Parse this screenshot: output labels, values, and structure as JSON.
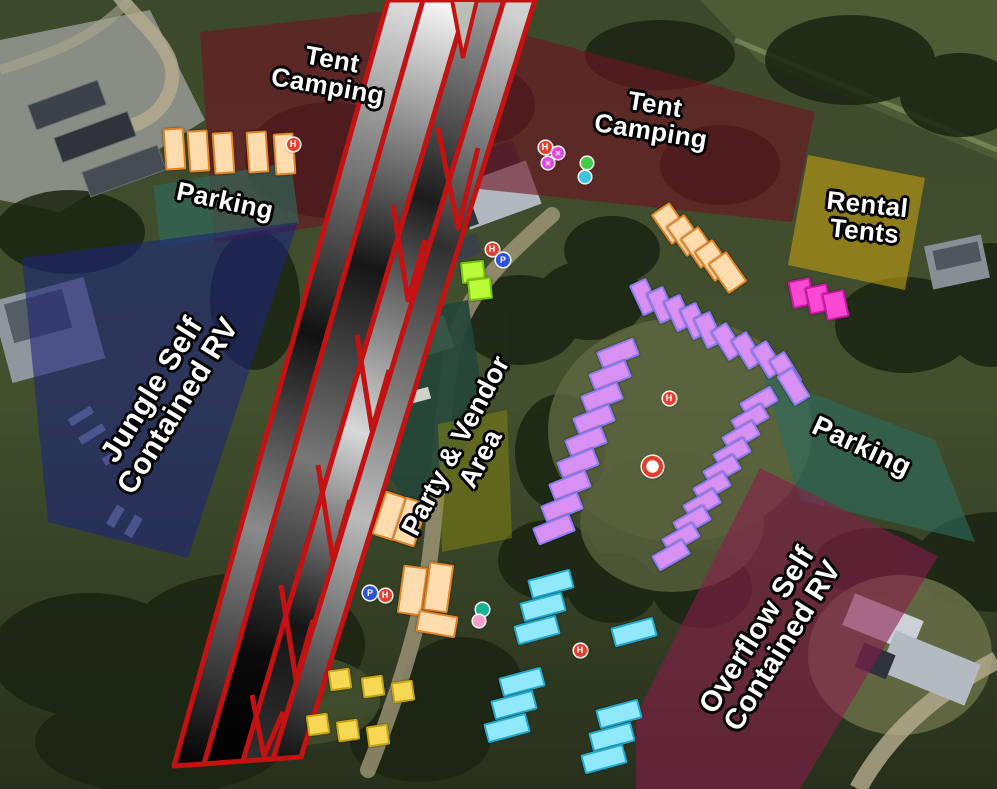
{
  "map": {
    "type": "campground-event-site-map",
    "background_style": "satellite-aerial",
    "hatch_band": {
      "stroke": "#c41111",
      "meaning": "closed-route-hatching"
    },
    "zones": [
      {
        "id": "tent-camping-nw",
        "fill": "#6e1422",
        "opacity": 0.62,
        "points": [
          [
            200,
            32
          ],
          [
            398,
            10
          ],
          [
            408,
            212
          ],
          [
            214,
            243
          ]
        ],
        "label_lines": [
          "Tent",
          "Camping"
        ],
        "label_x": 330,
        "label_y": 73,
        "label_rot": 10,
        "label_size": 26
      },
      {
        "id": "parking-nw",
        "fill": "#2e6b5c",
        "opacity": 0.64,
        "points": [
          [
            153,
            186
          ],
          [
            291,
            162
          ],
          [
            299,
            224
          ],
          [
            161,
            248
          ]
        ],
        "label_lines": [
          "Parking"
        ],
        "label_x": 225,
        "label_y": 201,
        "label_rot": 12,
        "label_size": 26
      },
      {
        "id": "jungle-self-contained-rv",
        "fill": "#1c2478",
        "opacity": 0.6,
        "points": [
          [
            22,
            258
          ],
          [
            298,
            222
          ],
          [
            188,
            558
          ],
          [
            48,
            522
          ]
        ],
        "label_lines": [
          "Jungle Self",
          "Contained RV"
        ],
        "label_x": 165,
        "label_y": 398,
        "label_rot": -58,
        "label_size": 30
      },
      {
        "id": "tent-camping-ne",
        "fill": "#6e1422",
        "opacity": 0.62,
        "points": [
          [
            497,
            28
          ],
          [
            815,
            112
          ],
          [
            792,
            222
          ],
          [
            470,
            188
          ]
        ],
        "label_lines": [
          "Tent",
          "Camping"
        ],
        "label_x": 653,
        "label_y": 118,
        "label_rot": 9,
        "label_size": 26
      },
      {
        "id": "rental-tents",
        "fill": "#c7a112",
        "opacity": 0.58,
        "points": [
          [
            808,
            155
          ],
          [
            925,
            178
          ],
          [
            905,
            290
          ],
          [
            788,
            265
          ]
        ],
        "label_lines": [
          "Rental",
          "Tents"
        ],
        "label_x": 866,
        "label_y": 218,
        "label_rot": 6,
        "label_size": 26
      },
      {
        "id": "party-vendor-area",
        "fill": "#8a8a10",
        "opacity": 0.48,
        "points": [
          [
            438,
            424
          ],
          [
            507,
            410
          ],
          [
            512,
            538
          ],
          [
            442,
            552
          ]
        ],
        "label_lines": [
          "Party & Vendor",
          "Area"
        ],
        "label_x": 468,
        "label_y": 452,
        "label_rot": -62,
        "label_size": 27
      },
      {
        "id": "parking-e",
        "fill": "#2e6b5c",
        "opacity": 0.64,
        "points": [
          [
            763,
            375
          ],
          [
            935,
            440
          ],
          [
            975,
            542
          ],
          [
            800,
            500
          ]
        ],
        "label_lines": [
          "Parking"
        ],
        "label_x": 862,
        "label_y": 446,
        "label_rot": 25,
        "label_size": 28
      },
      {
        "id": "overflow-self-contained-rv",
        "fill": "#8c1c4c",
        "opacity": 0.58,
        "points": [
          [
            760,
            468
          ],
          [
            938,
            556
          ],
          [
            800,
            789
          ],
          [
            636,
            789
          ],
          [
            636,
            716
          ]
        ],
        "label_lines": [
          "Overflow Self",
          "Contained RV"
        ],
        "label_x": 770,
        "label_y": 638,
        "label_rot": -58,
        "label_size": 29
      }
    ],
    "site_groups": [
      {
        "name": "orange-tent-site",
        "fill": "#ffdcae",
        "border": "#e08428",
        "w": 17,
        "h": 38,
        "rot": -4,
        "sites": [
          [
            172,
            147
          ],
          [
            196,
            149
          ],
          [
            221,
            151
          ],
          [
            255,
            150
          ],
          [
            282,
            152
          ]
        ]
      },
      {
        "name": "orange-tent-site",
        "fill": "#ffdcae",
        "border": "#e08428",
        "w": 19,
        "h": 33,
        "rot": -35,
        "sites": [
          [
            668,
            221
          ],
          [
            683,
            233
          ],
          [
            697,
            245
          ],
          [
            711,
            258
          ],
          [
            725,
            270
          ]
        ]
      },
      {
        "name": "orange-tent-site",
        "fill": "#ffdcae",
        "border": "#e08428",
        "w": 20,
        "h": 42,
        "rot": 18,
        "sites": [
          [
            388,
            514
          ],
          [
            408,
            520
          ]
        ]
      },
      {
        "name": "orange-tent-site",
        "fill": "#ffdcae",
        "border": "#e08428",
        "w": 21,
        "h": 45,
        "rot": 8,
        "sites": [
          [
            410,
            588
          ],
          [
            436,
            585
          ]
        ]
      },
      {
        "name": "orange-tent-site",
        "fill": "#ffdcae",
        "border": "#e08428",
        "w": 36,
        "h": 18,
        "rot": 10,
        "sites": [
          [
            435,
            622
          ]
        ]
      },
      {
        "name": "purple-rv-site",
        "fill": "#d891f2",
        "border": "#8a7df2",
        "w": 15,
        "h": 30,
        "rot": -25,
        "sites": [
          [
            642,
            295
          ],
          [
            659,
            303
          ],
          [
            676,
            311
          ],
          [
            692,
            319
          ],
          [
            706,
            328
          ]
        ]
      },
      {
        "name": "purple-rv-site",
        "fill": "#d891f2",
        "border": "#8a7df2",
        "w": 15,
        "h": 31,
        "rot": -32,
        "sites": [
          [
            725,
            339
          ],
          [
            745,
            348
          ],
          [
            765,
            357
          ],
          [
            783,
            368
          ],
          [
            791,
            384
          ]
        ]
      },
      {
        "name": "purple-rv-site",
        "fill": "#d891f2",
        "border": "#8a7df2",
        "w": 32,
        "h": 14,
        "rot": -30,
        "sites": [
          [
            757,
            400
          ],
          [
            748,
            417
          ],
          [
            739,
            434
          ],
          [
            730,
            451
          ],
          [
            720,
            468
          ],
          [
            710,
            485
          ],
          [
            700,
            502
          ],
          [
            690,
            519
          ],
          [
            679,
            536
          ],
          [
            669,
            553
          ]
        ]
      },
      {
        "name": "purple-rv-site",
        "fill": "#d891f2",
        "border": "#8a7df2",
        "w": 36,
        "h": 15,
        "rot": -22,
        "sites": [
          [
            616,
            351
          ],
          [
            608,
            373
          ],
          [
            600,
            395
          ],
          [
            592,
            417
          ],
          [
            584,
            439
          ],
          [
            576,
            461
          ],
          [
            568,
            483
          ],
          [
            560,
            505
          ],
          [
            552,
            527
          ]
        ]
      },
      {
        "name": "pink-site",
        "fill": "#fb48d3",
        "border": "#c718a0",
        "w": 19,
        "h": 24,
        "rot": -12,
        "sites": [
          [
            799,
            291
          ],
          [
            816,
            297
          ],
          [
            833,
            303
          ]
        ]
      },
      {
        "name": "cyan-site",
        "fill": "#8fe9fb",
        "border": "#25a9cc",
        "w": 40,
        "h": 16,
        "rot": -15,
        "sites": [
          [
            549,
            582
          ],
          [
            541,
            605
          ],
          [
            535,
            628
          ],
          [
            520,
            680
          ],
          [
            512,
            703
          ],
          [
            505,
            726
          ],
          [
            632,
            630
          ],
          [
            617,
            712
          ],
          [
            610,
            735
          ],
          [
            602,
            757
          ]
        ]
      },
      {
        "name": "yellow-site",
        "fill": "#f6d854",
        "border": "#c7a512",
        "w": 18,
        "h": 17,
        "rot": -8,
        "sites": [
          [
            338,
            677
          ],
          [
            371,
            684
          ],
          [
            401,
            689
          ],
          [
            316,
            722
          ],
          [
            346,
            728
          ],
          [
            376,
            733
          ]
        ]
      },
      {
        "name": "lime-site",
        "fill": "#b8fb36",
        "border": "#76c214",
        "w": 20,
        "h": 18,
        "rot": -6,
        "sites": [
          [
            471,
            270
          ],
          [
            478,
            287
          ]
        ]
      }
    ],
    "icons": [
      {
        "name": "hydrant-marker-icon",
        "color": "#e5402e",
        "glyph": "H",
        "d": 13,
        "points": [
          [
            293,
            144
          ],
          [
            545,
            147
          ],
          [
            492,
            249
          ],
          [
            669,
            398
          ],
          [
            580,
            650
          ],
          [
            385,
            595
          ]
        ]
      },
      {
        "name": "parking-marker-icon",
        "color": "#2d52d8",
        "glyph": "P",
        "d": 14,
        "points": [
          [
            503,
            260
          ],
          [
            370,
            593
          ]
        ]
      },
      {
        "name": "cross-marker-icon",
        "color": "#e144e8",
        "glyph": "✕",
        "d": 12,
        "points": [
          [
            558,
            153
          ],
          [
            548,
            163
          ]
        ]
      },
      {
        "name": "green-marker-icon",
        "color": "#3ecf44",
        "glyph": "",
        "d": 12,
        "points": [
          [
            587,
            163
          ]
        ]
      },
      {
        "name": "water-marker-icon",
        "color": "#3bc4dd",
        "glyph": "",
        "d": 12,
        "points": [
          [
            585,
            177
          ]
        ]
      },
      {
        "name": "teal-marker-icon",
        "color": "#18b394",
        "glyph": "",
        "d": 13,
        "points": [
          [
            482,
            609
          ]
        ]
      },
      {
        "name": "pink-marker-icon",
        "color": "#f2a0cb",
        "glyph": "",
        "d": 12,
        "points": [
          [
            479,
            621
          ]
        ]
      },
      {
        "name": "poi-marker-icon",
        "color": "#e23d2a",
        "glyph": "",
        "d": 21,
        "inner": "#ffffff",
        "points": [
          [
            652,
            466
          ]
        ]
      }
    ]
  }
}
